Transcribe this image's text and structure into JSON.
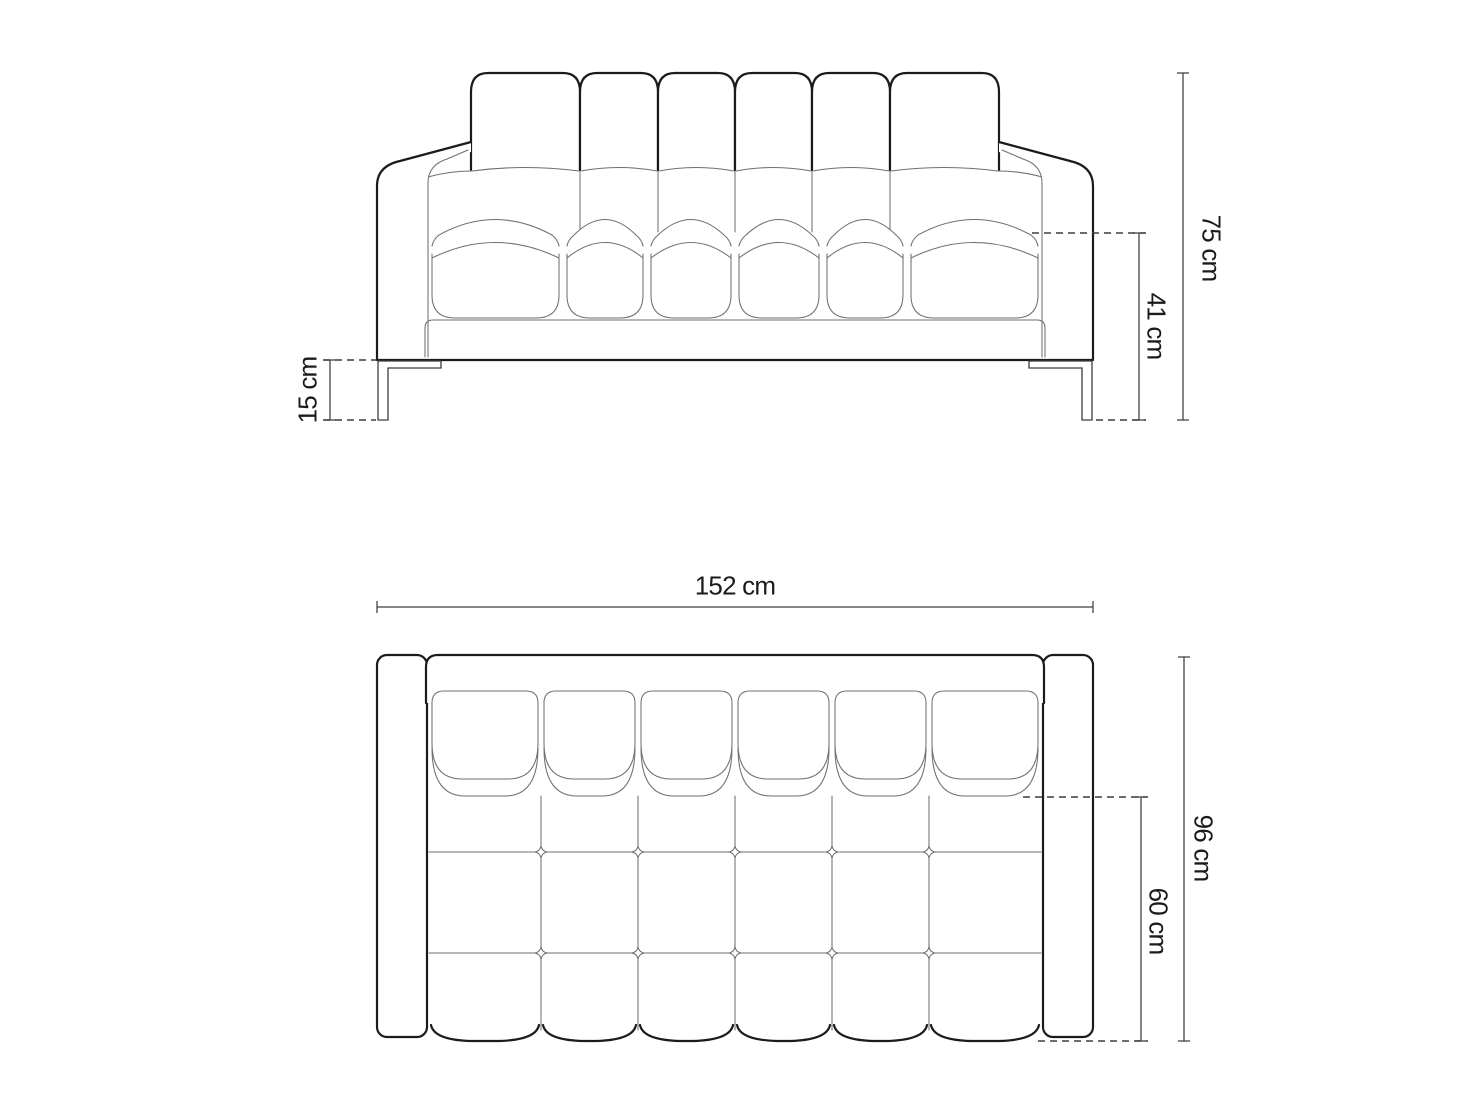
{
  "front_view": {
    "overall_height_label": "75 cm",
    "seat_height_label": "41 cm",
    "leg_height_label": "15 cm"
  },
  "top_view": {
    "overall_width_label": "152 cm",
    "overall_depth_label": "96 cm",
    "seat_depth_label": "60 cm"
  },
  "colors": {
    "outline": "#1b1b1b",
    "detail": "#6f6f6f",
    "dimension": "#3d3d3d",
    "background": "#ffffff"
  }
}
